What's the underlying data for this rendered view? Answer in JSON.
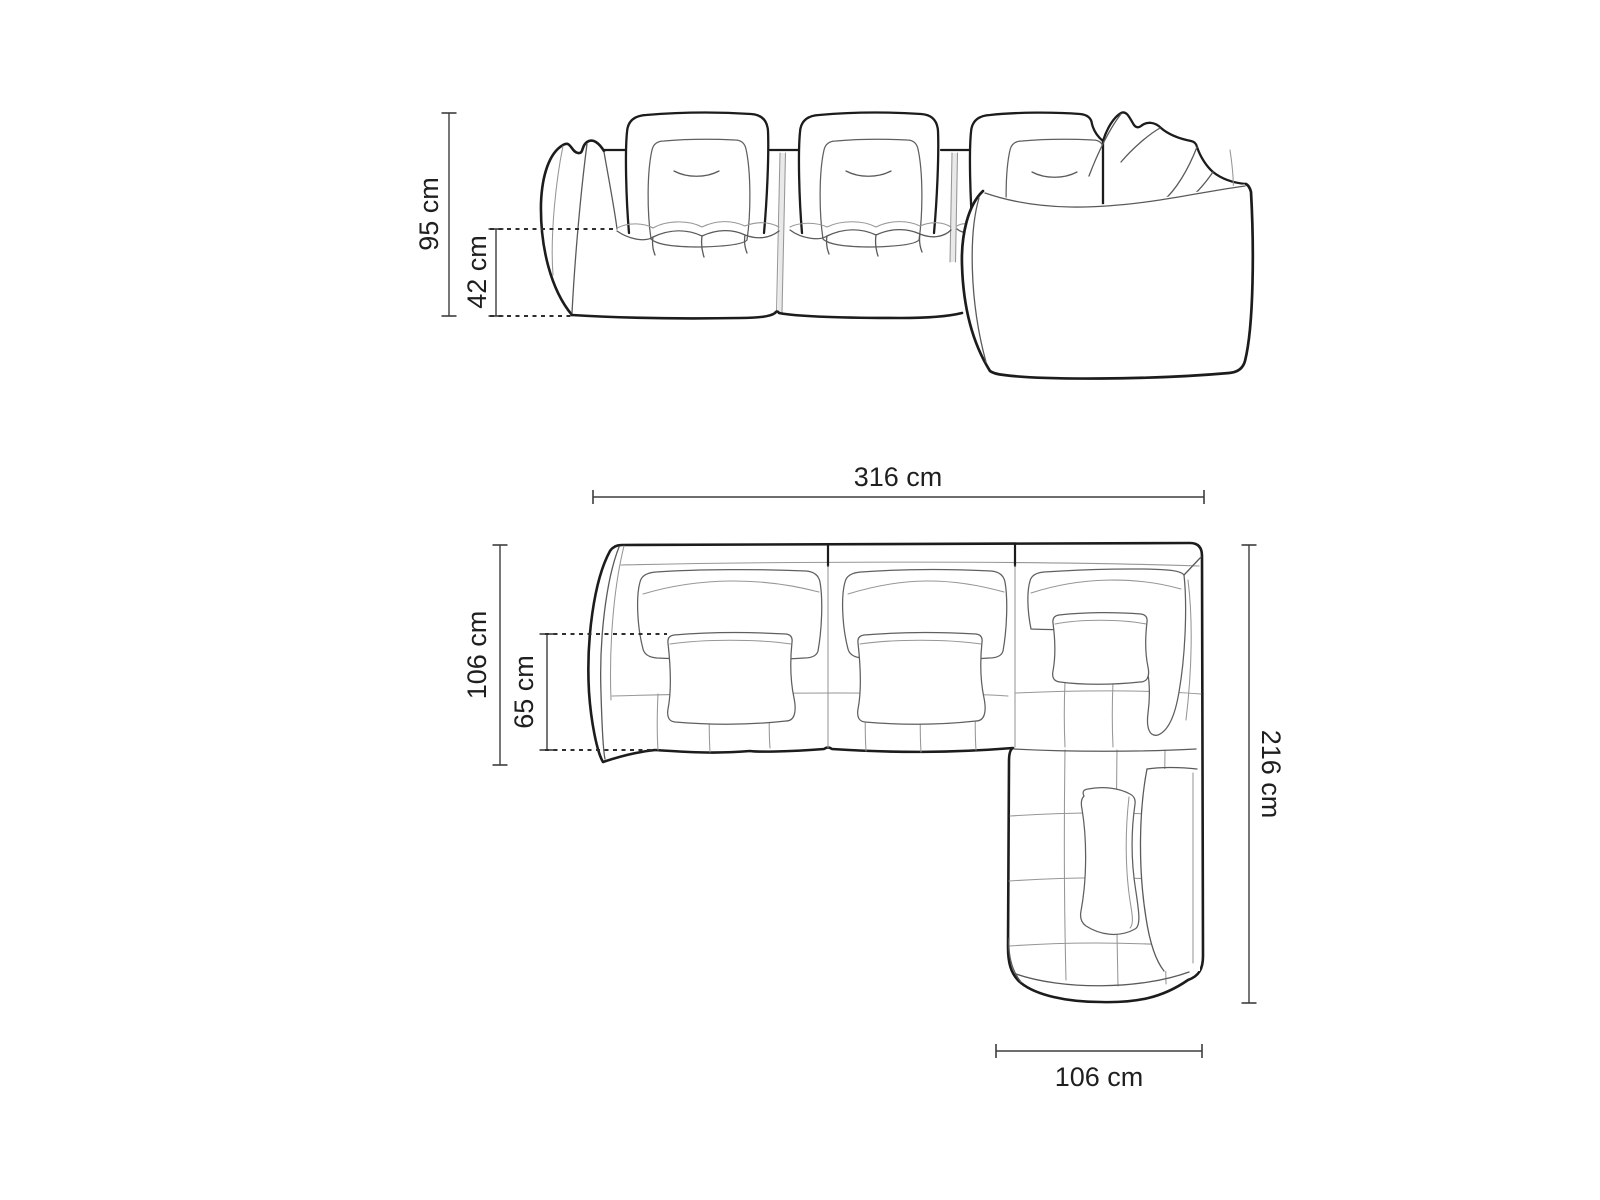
{
  "canvas": {
    "background": "#ffffff",
    "line_ink": "#1c1c1c",
    "line_detail": "#5f5f5f",
    "dimension_line_color": "#3d3d3d",
    "label_color": "#1f1f1f"
  },
  "views": {
    "front_elevation": {
      "dims": [
        {
          "id": "overall-height",
          "label": "95 cm"
        },
        {
          "id": "seat-height",
          "label": "42 cm"
        }
      ]
    },
    "top_plan": {
      "dims": [
        {
          "id": "overall-width",
          "label": "316 cm"
        },
        {
          "id": "row-depth",
          "label": "106 cm"
        },
        {
          "id": "seat-depth",
          "label": "65 cm"
        },
        {
          "id": "overall-depth",
          "label": "216 cm"
        },
        {
          "id": "chaise-width",
          "label": "106 cm"
        }
      ]
    }
  }
}
